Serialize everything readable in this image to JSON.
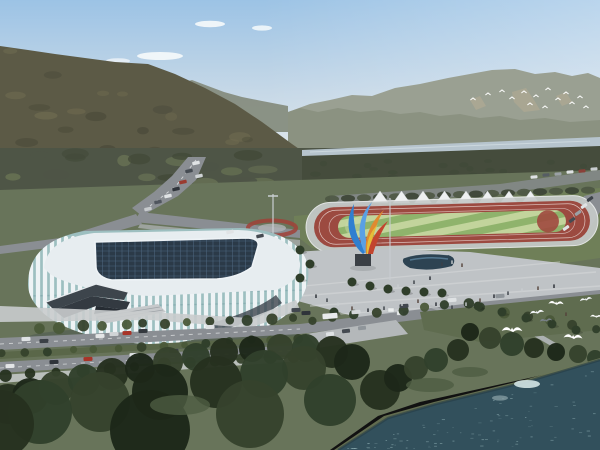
{
  "scene": {
    "title": "Aerial rendering of a riverside sports stadium complex",
    "elements": [
      "hazy blue sky with clouds",
      "forested mountain ridge left",
      "distant grey-green mountain range right",
      "flock of small birds over far ridge",
      "river band in midground",
      "highway with traffic descending from hills",
      "white ribbed stadium with dark gridded glass roof",
      "dark angular entrance terraces with stairs",
      "running track with striped green infield",
      "row of white canopy tents",
      "multicolored container wall",
      "blue-orange abstract sculpture on pedestal",
      "grey plaza with dark pond and pedestrians",
      "tree-lined boulevards with cars",
      "parking areas",
      "dark foreshore woodland",
      "teal lake water with ripples",
      "white egrets flying in foreground"
    ]
  },
  "palette": {
    "sky_top": "#9cc3e5",
    "sky_mid": "#c6d8e7",
    "sky_horizon": "#e4eaec",
    "cloud": "#f6fafb",
    "mountain_left": "#5c5a46",
    "mountain_left_shade": "#4b4b3a",
    "mountain_left_light": "#6e6a50",
    "ridge_left_far": "#868d7f",
    "range_right": "#9aa092",
    "range_right_near": "#8a9080",
    "scree": "#b2aa93",
    "tree_band": "#4e5546",
    "tree_blob_dark": "#434a39",
    "tree_blob_light": "#667053",
    "river": "#b6c4cd",
    "grass": "#68745a",
    "lawn": "#6f7f58",
    "grass_dark": "#5a6749",
    "road": "#8a8e93",
    "road_light": "#b4b8ba",
    "walk_light": "#c9cccd",
    "plaza": "#bfc3c6",
    "track_red": "#9c4a40",
    "track_apron": "#c6cac9",
    "infield_light": "#c2d49c",
    "infield_dark": "#8fb36c",
    "dzone_red": "#a0493f",
    "tent": "#eef0f1",
    "stadium_glass": "#9dbfc0",
    "stadium_rib": "#eef3f5",
    "roof_band": "#e7edf0",
    "roof_dark": "#2b3a48",
    "roof_grid": "#54708a",
    "entrance_dark": "#3d454c",
    "pond": "#2d4352",
    "water": "#32505c",
    "ripple": "#a9c9cc",
    "water_shine": "#d3e4e4",
    "shore": "#6b7757",
    "forest": "#26311f",
    "forest_mid": "#36422c",
    "forest_light": "#4a5839",
    "bird": "#ffffff",
    "person": "#262b31",
    "pole": "#c9ced1",
    "flowerbed": "#a04238",
    "sculpt_blue": "#2f7fd0",
    "sculpt_blue2": "#5aa0e4",
    "sculpt_orange": "#e08a30",
    "sculpt_yellow": "#e6c33a",
    "sculpt_red": "#c2452f"
  },
  "scenery": {
    "tents": {
      "count": 8,
      "x_start": 380,
      "spacing": 21.5,
      "half_w": 8.5,
      "apex_y": 191,
      "base_y": 203
    },
    "wall_blocks": {
      "x_start": 336,
      "y": 205,
      "w": 16,
      "h": 8.5,
      "colors": [
        "#a8463a",
        "#c07a3a",
        "#a8463a",
        "#4f9647",
        "#4f9647",
        "#3f6cb5",
        "#7a4ba2",
        "#a8463a",
        "#7a4ba2",
        "#3f6cb5",
        "#a8463a",
        "#3f6cb5",
        "#7a4ba2"
      ]
    },
    "flock_birds": [
      [
        473,
        100
      ],
      [
        488,
        95
      ],
      [
        502,
        92
      ],
      [
        512,
        99
      ],
      [
        524,
        93
      ],
      [
        536,
        97
      ],
      [
        548,
        90
      ],
      [
        530,
        105
      ],
      [
        545,
        108
      ],
      [
        558,
        100
      ],
      [
        566,
        94
      ],
      [
        572,
        104
      ],
      [
        580,
        98
      ],
      [
        586,
        108
      ]
    ],
    "large_birds": [
      [
        512,
        331,
        1.15,
        "#ffffff"
      ],
      [
        537,
        313,
        0.8,
        "#f4f6f8"
      ],
      [
        556,
        304,
        0.85,
        "#ffffff"
      ],
      [
        573,
        338,
        1.05,
        "#ffffff"
      ],
      [
        586,
        300,
        0.7,
        "#f0f3f5"
      ],
      [
        596,
        317,
        0.65,
        "#ffffff"
      ],
      [
        546,
        321,
        0.7,
        "#7a828b"
      ]
    ],
    "people": [
      [
        316,
        298
      ],
      [
        327,
        302
      ],
      [
        338,
        306
      ],
      [
        352,
        310
      ],
      [
        368,
        312
      ],
      [
        384,
        310
      ],
      [
        402,
        306
      ],
      [
        418,
        303
      ],
      [
        436,
        306
      ],
      [
        452,
        309
      ],
      [
        466,
        306
      ],
      [
        480,
        302
      ],
      [
        494,
        298
      ],
      [
        508,
        295
      ],
      [
        522,
        292
      ],
      [
        538,
        290
      ],
      [
        554,
        288
      ],
      [
        442,
        266
      ],
      [
        452,
        264
      ],
      [
        462,
        267
      ],
      [
        430,
        280
      ],
      [
        414,
        284
      ],
      [
        398,
        288
      ],
      [
        566,
        316
      ]
    ],
    "cars": {
      "front": [
        [
          26,
          339,
          "#e0e3e5"
        ],
        [
          44,
          341,
          "#3b4046"
        ],
        [
          100,
          336,
          "#e3e5e6"
        ],
        [
          114,
          334,
          "#d0d4d6"
        ],
        [
          127,
          333,
          "#a83428"
        ],
        [
          143,
          331,
          "#33383e"
        ],
        [
          210,
          327,
          "#dfe2e4"
        ],
        [
          296,
          310,
          "#41474e"
        ],
        [
          306,
          313,
          "#2f343a"
        ],
        [
          10,
          366,
          "#e3e5e6"
        ],
        [
          54,
          362,
          "#2f343a"
        ],
        [
          88,
          359,
          "#a83428"
        ],
        [
          134,
          355,
          "#dfe2e4"
        ],
        [
          174,
          351,
          "#3b4046"
        ]
      ],
      "highway": [
        [
          196,
          163,
          "#e0e3e5"
        ],
        [
          189,
          171,
          "#454b52"
        ],
        [
          199,
          176,
          "#cfd3d5"
        ],
        [
          183,
          182,
          "#9a3b30"
        ],
        [
          176,
          189,
          "#30353b"
        ],
        [
          168,
          196,
          "#e0e3e5"
        ],
        [
          158,
          202,
          "#50565e"
        ],
        [
          148,
          209,
          "#c6cacd"
        ],
        [
          230,
          232,
          "#e0e3e5"
        ],
        [
          260,
          236,
          "#454b52"
        ]
      ],
      "right_road": [
        [
          330,
          316,
          "#e9ebec",
          15,
          5.5
        ],
        [
          356,
          312,
          "#d4d7d9",
          9,
          4
        ],
        [
          404,
          306,
          "#41474e",
          9,
          4
        ],
        [
          452,
          300,
          "#dfe2e4",
          9,
          4
        ],
        [
          500,
          296,
          "#8f959a",
          9,
          4
        ]
      ],
      "parking": [
        [
          330,
          334,
          "#dfe2e4"
        ],
        [
          346,
          331,
          "#444a51"
        ],
        [
          362,
          328,
          "#8f959a"
        ]
      ],
      "parked_right": [
        [
          566,
          228,
          "#dfe2e4"
        ],
        [
          572,
          220,
          "#454b52"
        ],
        [
          578,
          213,
          "#9aa0a5"
        ],
        [
          584,
          206,
          "#dfe2e4"
        ],
        [
          590,
          199,
          "#3d434a"
        ]
      ],
      "parked_top": [
        [
          534,
          177,
          "#dfe2e4"
        ],
        [
          546,
          175,
          "#565d64"
        ],
        [
          558,
          174,
          "#9aa0a5"
        ],
        [
          570,
          172,
          "#dfe2e4"
        ],
        [
          582,
          171,
          "#8a4038"
        ],
        [
          594,
          169,
          "#c8cccf"
        ]
      ]
    }
  }
}
